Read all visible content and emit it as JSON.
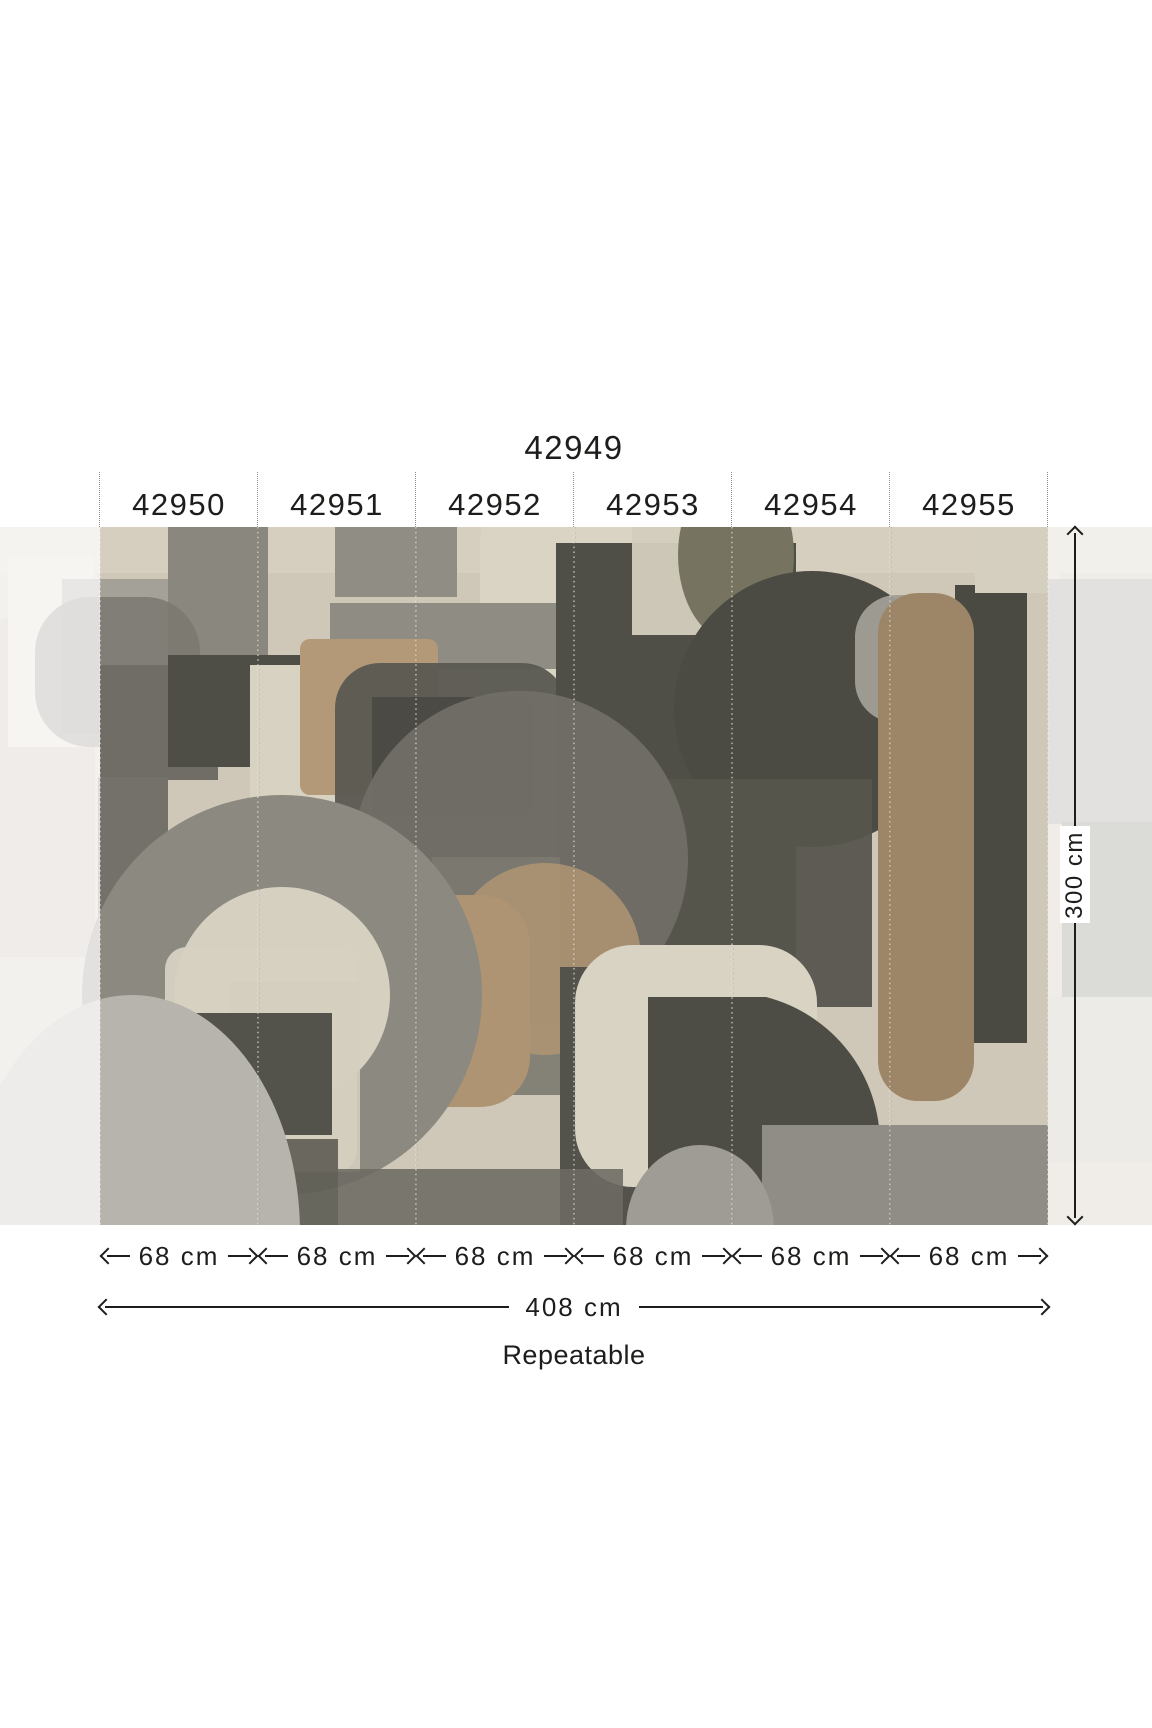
{
  "product": {
    "set_number": "42949",
    "panels": [
      {
        "number": "42950",
        "width": "68 cm"
      },
      {
        "number": "42951",
        "width": "68 cm"
      },
      {
        "number": "42952",
        "width": "68 cm"
      },
      {
        "number": "42953",
        "width": "68 cm"
      },
      {
        "number": "42954",
        "width": "68 cm"
      },
      {
        "number": "42955",
        "width": "68 cm"
      },
      {
        "number": "42949",
        "width": "408 cm"
      }
    ],
    "total_width": "408 cm",
    "height": "300 cm",
    "repeat_note": "Repeatable"
  },
  "colors": {
    "ink": "#1d1d1b",
    "mural_background": "#cfc8b9",
    "mural_charcoal": "#4b4a43",
    "mural_gray": "#8b8980",
    "mural_light_gray": "#b6b4ac",
    "mural_cream": "#d8d2c3",
    "mural_tan": "#ae9473",
    "mural_brown": "#9d8568"
  }
}
